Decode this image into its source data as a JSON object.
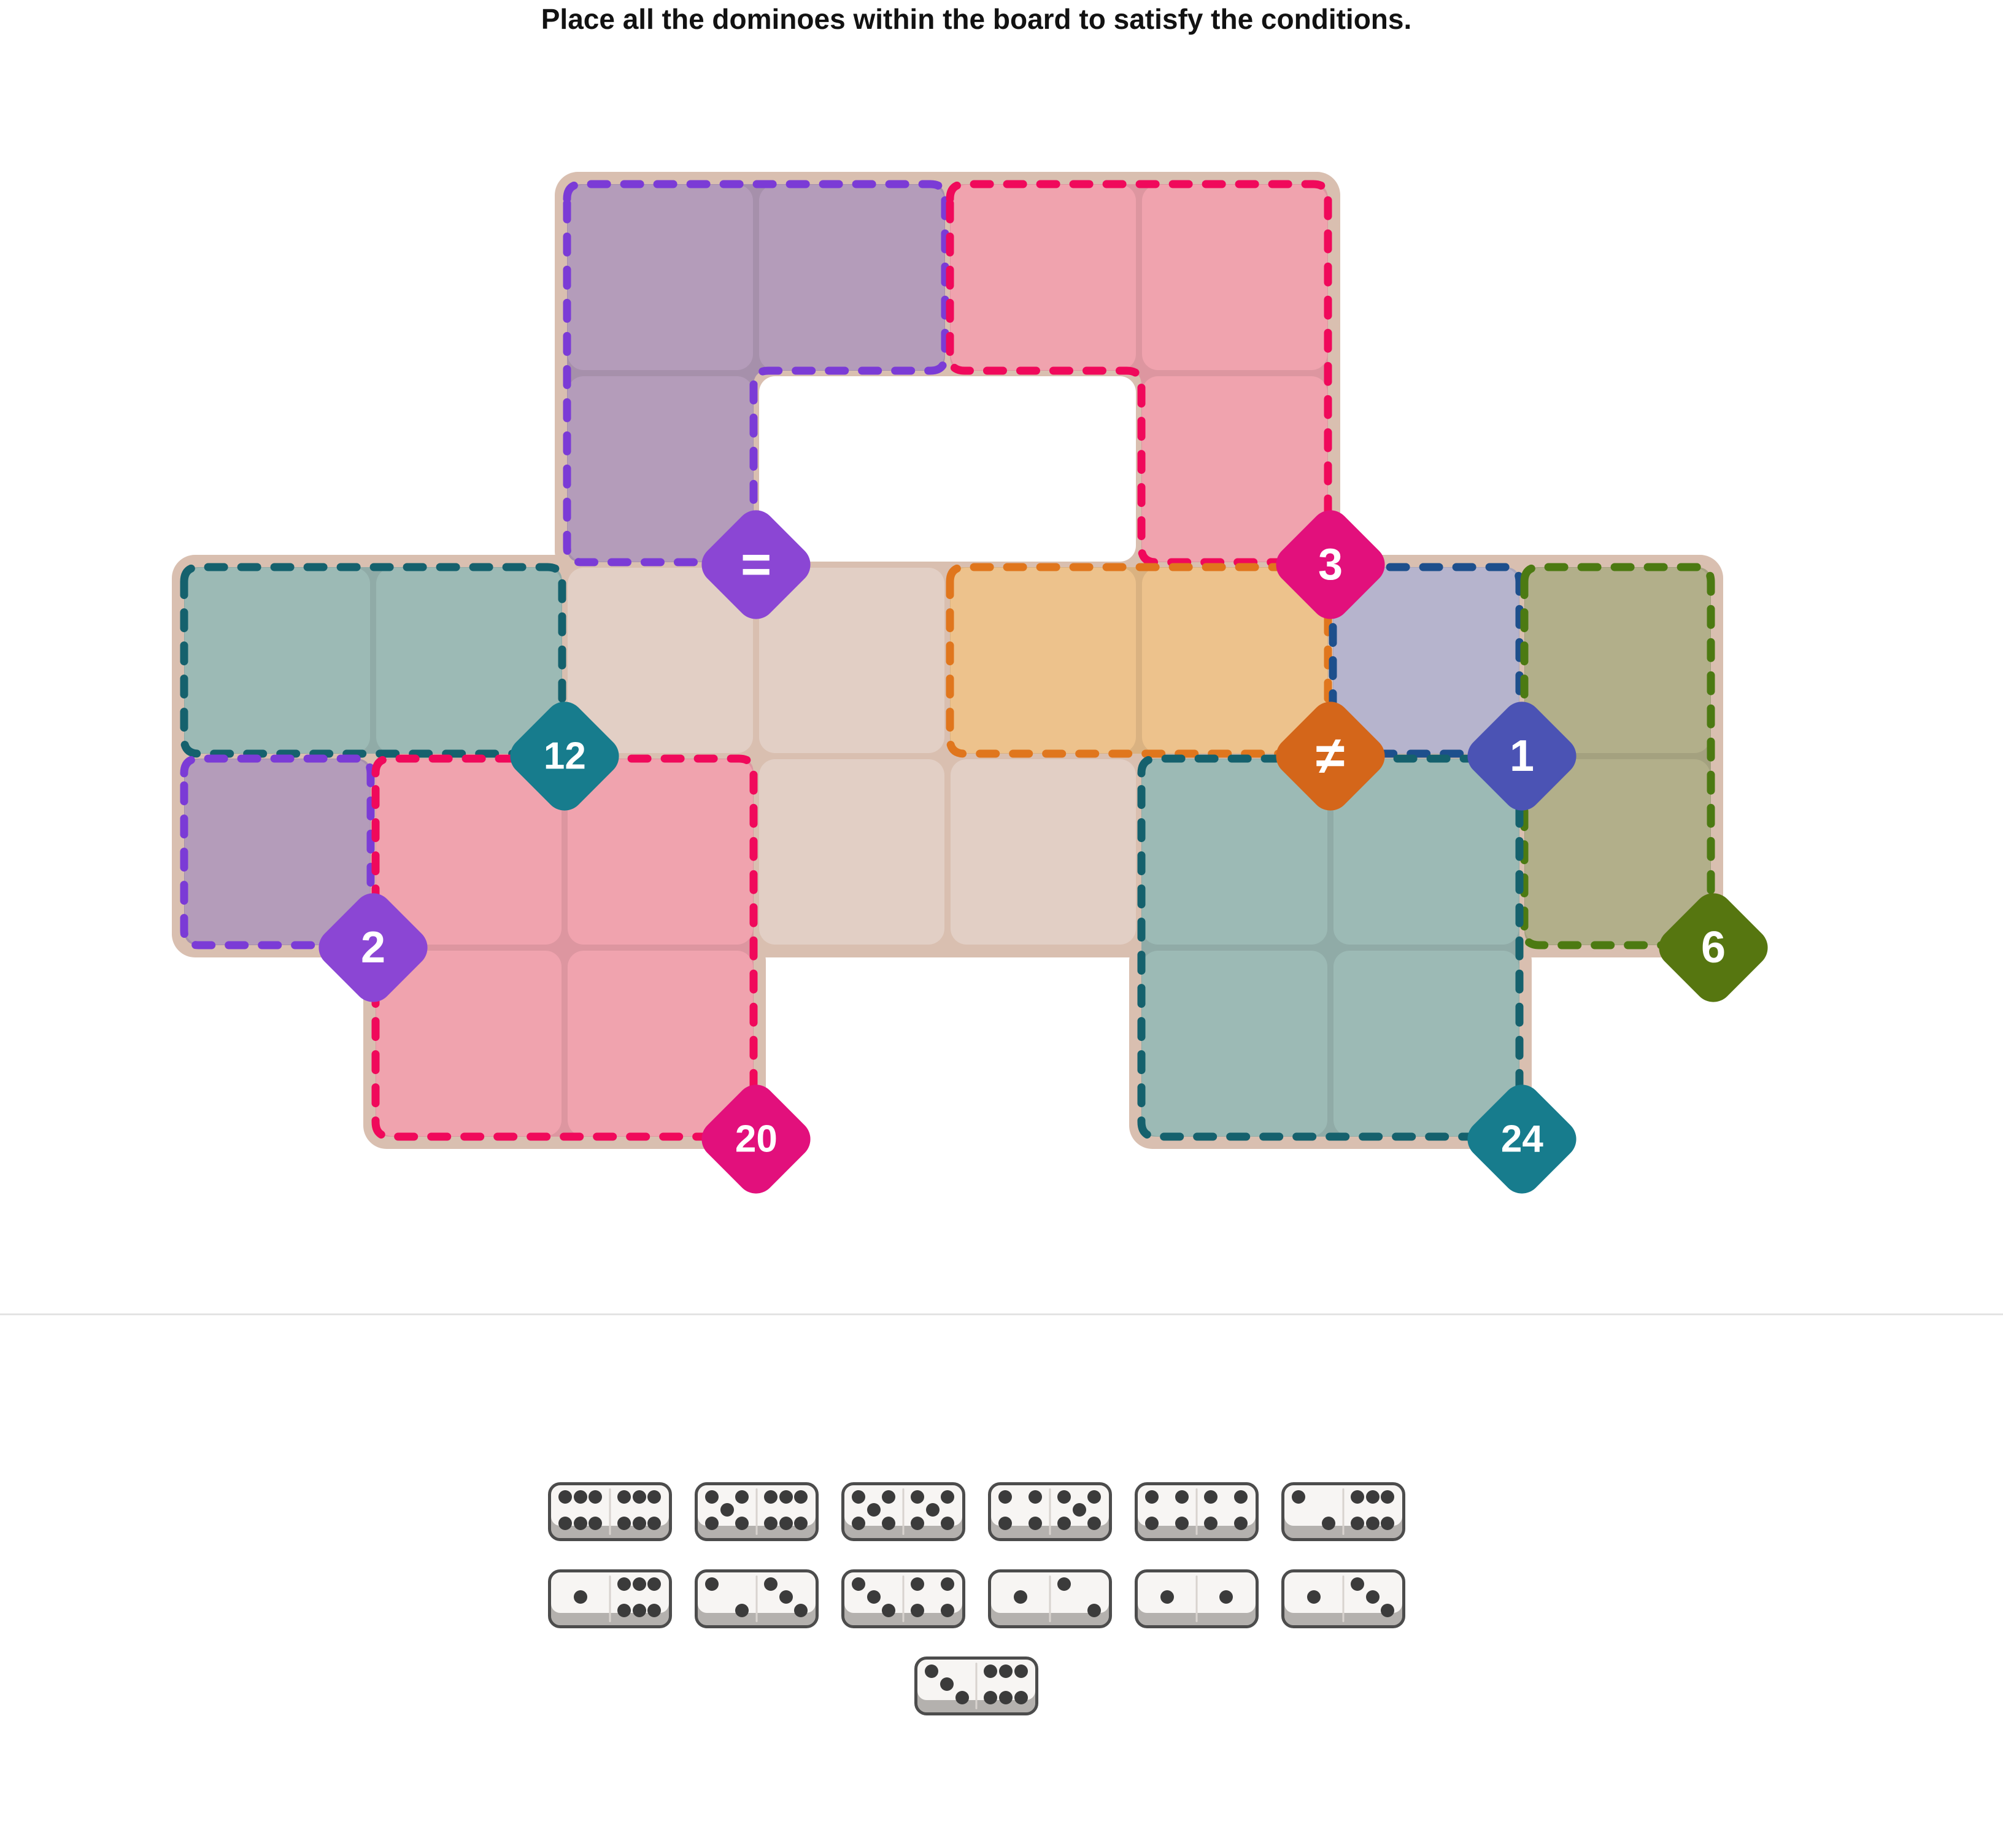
{
  "title": "Place all the dominoes within the board to satisfy the conditions.",
  "board": {
    "grid": {
      "cols": 8,
      "rows": 5
    },
    "colors": {
      "base": "#d9bfb0",
      "plain_cell": "#e2cfc5",
      "hole": "#ffffff"
    },
    "plain_cells": [
      [
        3,
        3
      ],
      [
        4,
        3
      ],
      [
        4,
        4
      ],
      [
        5,
        4
      ]
    ],
    "hole_cells": [
      [
        4,
        2
      ],
      [
        5,
        2
      ]
    ],
    "regions": [
      {
        "id": "equals-purple",
        "condition": "=",
        "cells": [
          [
            3,
            1
          ],
          [
            4,
            1
          ],
          [
            3,
            2
          ]
        ],
        "badge_cell": [
          3,
          2
        ],
        "border_color": "#7b3bd6",
        "fill": "#b49cba",
        "badge_color": "#8b46d4"
      },
      {
        "id": "sum-3-pink",
        "condition": "3",
        "cells": [
          [
            5,
            1
          ],
          [
            6,
            1
          ],
          [
            6,
            2
          ]
        ],
        "badge_cell": [
          6,
          2
        ],
        "border_color": "#f0095b",
        "fill": "#f0a3ae",
        "badge_color": "#e2107c"
      },
      {
        "id": "sum-12-teal",
        "condition": "12",
        "cells": [
          [
            1,
            3
          ],
          [
            2,
            3
          ]
        ],
        "badge_cell": [
          2,
          3
        ],
        "border_color": "#15616d",
        "fill": "#9cbab5",
        "badge_color": "#177c8d"
      },
      {
        "id": "all-different-orange",
        "condition": "≠",
        "cells": [
          [
            5,
            3
          ],
          [
            6,
            3
          ]
        ],
        "badge_cell": [
          6,
          3
        ],
        "border_color": "#e0761d",
        "fill": "#edc28c",
        "badge_color": "#d4661a"
      },
      {
        "id": "value-1-navy",
        "condition": "1",
        "cells": [
          [
            7,
            3
          ]
        ],
        "badge_cell": [
          7,
          3
        ],
        "border_color": "#1d4f8c",
        "fill": "#b6b4cd",
        "badge_color": "#4b53b4"
      },
      {
        "id": "sum-6-olive",
        "condition": "6",
        "cells": [
          [
            8,
            3
          ],
          [
            8,
            4
          ]
        ],
        "badge_cell": [
          8,
          4
        ],
        "border_color": "#4c7a12",
        "fill": "#b2af8a",
        "badge_color": "#567610"
      },
      {
        "id": "value-2-purple",
        "condition": "2",
        "cells": [
          [
            1,
            4
          ]
        ],
        "badge_cell": [
          1,
          4
        ],
        "border_color": "#7b3bd6",
        "fill": "#b49cba",
        "badge_color": "#8b46d4"
      },
      {
        "id": "sum-20-pink",
        "condition": "20",
        "cells": [
          [
            2,
            4
          ],
          [
            3,
            4
          ],
          [
            2,
            5
          ],
          [
            3,
            5
          ]
        ],
        "badge_cell": [
          3,
          5
        ],
        "border_color": "#f0095b",
        "fill": "#f0a3ae",
        "badge_color": "#e2107c"
      },
      {
        "id": "sum-24-teal",
        "condition": "24",
        "cells": [
          [
            6,
            4
          ],
          [
            7,
            4
          ],
          [
            6,
            5
          ],
          [
            7,
            5
          ]
        ],
        "badge_cell": [
          7,
          5
        ],
        "border_color": "#15616d",
        "fill": "#9cbab5",
        "badge_color": "#177c8d"
      }
    ]
  },
  "tray": {
    "dominoes_rows": [
      [
        [
          6,
          6
        ],
        [
          5,
          6
        ],
        [
          5,
          5
        ],
        [
          4,
          5
        ],
        [
          4,
          4
        ],
        [
          2,
          6
        ]
      ],
      [
        [
          1,
          6
        ],
        [
          2,
          3
        ],
        [
          3,
          4
        ],
        [
          1,
          2
        ],
        [
          1,
          1
        ],
        [
          1,
          3
        ]
      ],
      [
        [
          3,
          6
        ]
      ]
    ],
    "pip_color": "#3b3b3b",
    "face_color": "#f7f5f3",
    "edge_color": "#b4b1ae",
    "outline_color": "#4c4c4c",
    "slot_line_color": "#d8d3cf"
  },
  "divider_color": "#e3e3e3"
}
